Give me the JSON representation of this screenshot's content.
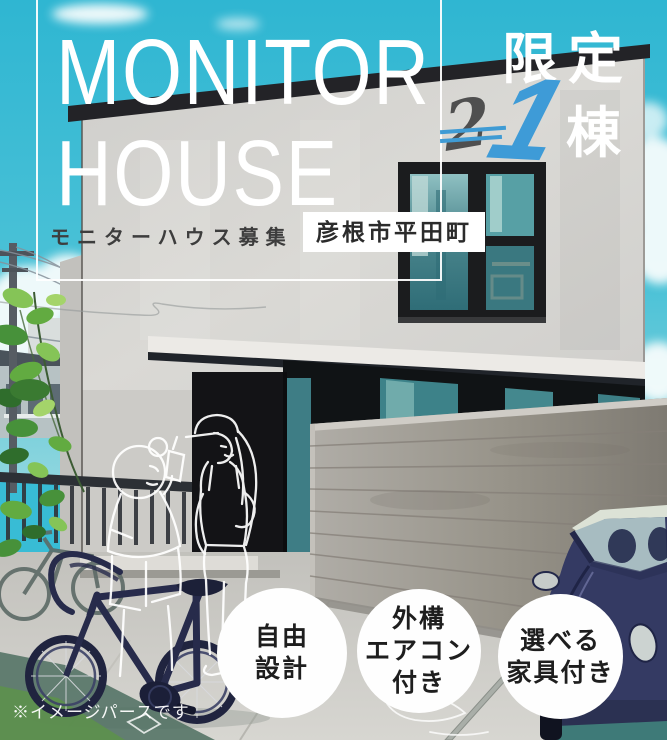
{
  "poster": {
    "title_line1": "MONITOR",
    "title_line2": "HOUSE",
    "subtitle": "モニターハウス募集",
    "location": "彦根市平田町",
    "limited": {
      "label": "限定",
      "old_count": "2",
      "count": "1",
      "unit": "棟"
    },
    "features": [
      {
        "lines": [
          "自由",
          "設計"
        ]
      },
      {
        "lines": [
          "外構",
          "エアコン",
          "付き"
        ]
      },
      {
        "lines": [
          "選べる",
          "家具付き"
        ]
      }
    ],
    "disclaimer": "※イメージパースです"
  },
  "colors": {
    "sky_teal": "#38bcd5",
    "accent_blue": "#3f9bd4",
    "facade_gray": "#d7d6d2",
    "roof_dark": "#232327",
    "window_glass_teal": "#4b868d",
    "fence_wood_gray": "#9b9790",
    "vehicle_navy": "#343a63",
    "text_dark": "#2b2b2b",
    "badge_white": "#ffffff"
  },
  "illustration": {
    "scene": "illustrated modern house exterior",
    "elements": [
      "house",
      "large-window",
      "wood-fence",
      "entrance-door",
      "people-sketch",
      "road-bicycle",
      "background-bicycle",
      "navy-car",
      "utility-pole",
      "foliage",
      "clouds",
      "driveway"
    ]
  }
}
